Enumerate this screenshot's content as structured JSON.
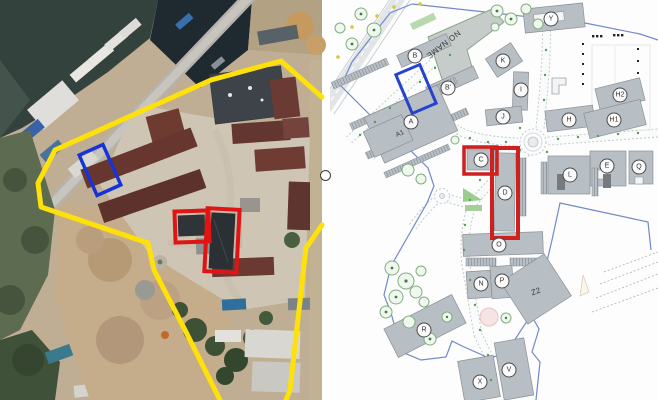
{
  "map": {
    "labels": {
      "A": "A",
      "A1": "A1",
      "B": "B",
      "B_prime": "B'",
      "C": "C",
      "D": "D",
      "E": "E",
      "H": "H",
      "H1": "H1",
      "H2": "H2",
      "I": "I",
      "J": "J",
      "K": "K",
      "L": "L",
      "N": "N",
      "O": "O",
      "P": "P",
      "Q": "Q",
      "R": "R",
      "V": "V",
      "X": "X",
      "Y": "Y",
      "Z2": "Z2",
      "no_name": "NO NAME"
    },
    "colors": {
      "building_fill": "#b7bec4",
      "building_stroke": "#8a9196",
      "boundary_blue": "#7289c9",
      "highlight_red": "#cf1f1f",
      "highlight_blue": "#2543cc",
      "tree_green": "#7fae7f",
      "road_edge": "#c3c9cd"
    }
  },
  "satellite": {
    "colors": {
      "boundary_yellow": "#ffe10a",
      "highlight_red": "#e01414",
      "highlight_blue": "#1634d6"
    }
  }
}
